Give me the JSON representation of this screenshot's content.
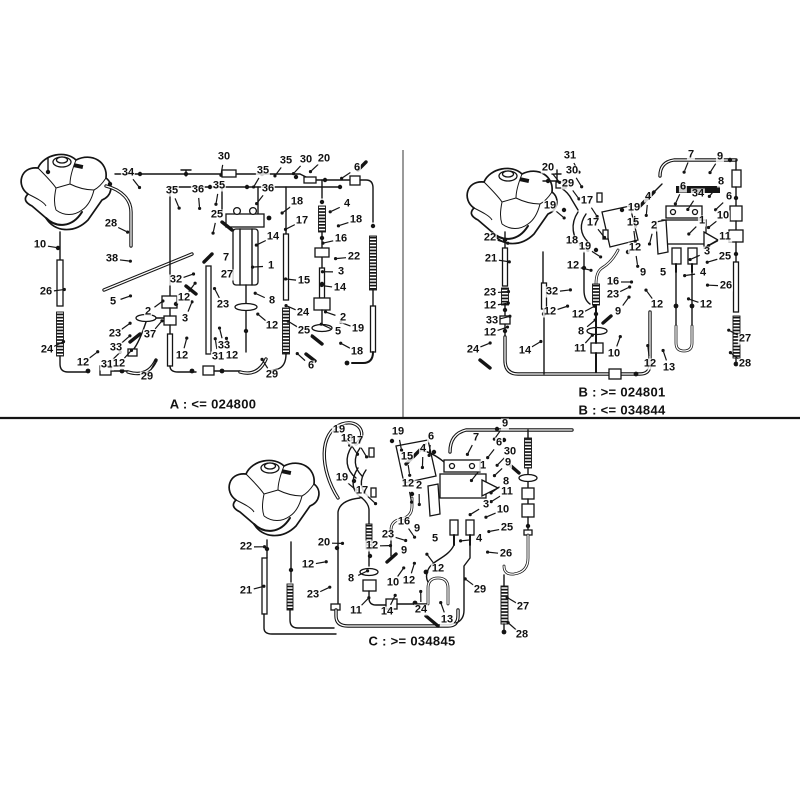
{
  "page": {
    "background": "#ffffff",
    "ink": "#141414",
    "divider_gray": "#9a9a9a"
  },
  "sections": [
    {
      "id": "A",
      "name": "variant-A-diagram",
      "captions": [
        {
          "text": "A : <= 024800",
          "x": 213,
          "y": 404
        }
      ],
      "focus": [
        205,
        270
      ],
      "callouts": [
        [
          "30",
          224,
          157
        ],
        [
          "35",
          263,
          171
        ],
        [
          "35",
          286,
          161
        ],
        [
          "30",
          306,
          160
        ],
        [
          "20",
          324,
          159
        ],
        [
          "6",
          357,
          168
        ],
        [
          "35",
          172,
          191
        ],
        [
          "36",
          198,
          190
        ],
        [
          "35",
          219,
          186
        ],
        [
          "36",
          268,
          189
        ],
        [
          "34",
          128,
          173
        ],
        [
          "28",
          111,
          224
        ],
        [
          "10",
          40,
          245
        ],
        [
          "26",
          46,
          292
        ],
        [
          "24",
          47,
          350
        ],
        [
          "38",
          112,
          259
        ],
        [
          "25",
          217,
          215
        ],
        [
          "18",
          297,
          202
        ],
        [
          "17",
          302,
          221
        ],
        [
          "16",
          341,
          239
        ],
        [
          "4",
          347,
          204
        ],
        [
          "18",
          356,
          220
        ],
        [
          "14",
          273,
          237
        ],
        [
          "7",
          226,
          258
        ],
        [
          "1",
          271,
          266
        ],
        [
          "22",
          354,
          257
        ],
        [
          "32",
          176,
          280
        ],
        [
          "27",
          227,
          275
        ],
        [
          "15",
          304,
          281
        ],
        [
          "3",
          341,
          272
        ],
        [
          "14",
          340,
          288
        ],
        [
          "5",
          113,
          302
        ],
        [
          "23",
          115,
          334
        ],
        [
          "33",
          116,
          348
        ],
        [
          "2",
          148,
          312
        ],
        [
          "12",
          184,
          298
        ],
        [
          "3",
          185,
          319
        ],
        [
          "37",
          150,
          335
        ],
        [
          "23",
          223,
          305
        ],
        [
          "33",
          224,
          346
        ],
        [
          "12",
          83,
          363
        ],
        [
          "31",
          107,
          365
        ],
        [
          "12",
          119,
          364
        ],
        [
          "29",
          147,
          377
        ],
        [
          "12",
          182,
          356
        ],
        [
          "31",
          218,
          357
        ],
        [
          "12",
          232,
          356
        ],
        [
          "29",
          272,
          375
        ],
        [
          "8",
          272,
          301
        ],
        [
          "24",
          303,
          313
        ],
        [
          "2",
          343,
          318
        ],
        [
          "12",
          272,
          326
        ],
        [
          "25",
          304,
          331
        ],
        [
          "5",
          338,
          332
        ],
        [
          "19",
          358,
          329
        ],
        [
          "18",
          357,
          352
        ],
        [
          "6",
          311,
          366
        ]
      ]
    },
    {
      "id": "B",
      "name": "variant-B-diagram",
      "captions": [
        {
          "text": "B : >= 024801",
          "x": 622,
          "y": 392
        },
        {
          "text": "B : <= 034844",
          "x": 622,
          "y": 410
        }
      ],
      "focus": [
        640,
        282
      ],
      "callouts": [
        [
          "31",
          570,
          156
        ],
        [
          "20",
          548,
          168
        ],
        [
          "30",
          572,
          171
        ],
        [
          "29",
          568,
          184
        ],
        [
          "19",
          550,
          206
        ],
        [
          "17",
          587,
          201
        ],
        [
          "19",
          634,
          208
        ],
        [
          "15",
          633,
          223
        ],
        [
          "17",
          593,
          223
        ],
        [
          "18",
          572,
          241
        ],
        [
          "19",
          585,
          247
        ],
        [
          "12",
          635,
          248
        ],
        [
          "22",
          490,
          238
        ],
        [
          "21",
          491,
          259
        ],
        [
          "12",
          573,
          266
        ],
        [
          "16",
          613,
          282
        ],
        [
          "7",
          691,
          155
        ],
        [
          "9",
          720,
          157
        ],
        [
          "6",
          683,
          187
        ],
        [
          "8",
          721,
          182
        ],
        [
          "4",
          648,
          197
        ],
        [
          "34",
          698,
          194
        ],
        [
          "6",
          729,
          197
        ],
        [
          "10",
          723,
          216
        ],
        [
          "1",
          702,
          221
        ],
        [
          "2",
          654,
          226
        ],
        [
          "11",
          725,
          237
        ],
        [
          "3",
          707,
          252
        ],
        [
          "25",
          725,
          257
        ],
        [
          "9",
          643,
          273
        ],
        [
          "5",
          663,
          273
        ],
        [
          "4",
          703,
          273
        ],
        [
          "26",
          726,
          286
        ],
        [
          "23",
          490,
          293
        ],
        [
          "12",
          490,
          306
        ],
        [
          "33",
          492,
          321
        ],
        [
          "12",
          490,
          333
        ],
        [
          "24",
          473,
          350
        ],
        [
          "14",
          525,
          351
        ],
        [
          "32",
          552,
          292
        ],
        [
          "12",
          550,
          312
        ],
        [
          "23",
          613,
          295
        ],
        [
          "12",
          578,
          315
        ],
        [
          "9",
          618,
          312
        ],
        [
          "8",
          581,
          332
        ],
        [
          "11",
          580,
          349
        ],
        [
          "10",
          614,
          354
        ],
        [
          "12",
          650,
          364
        ],
        [
          "12",
          657,
          305
        ],
        [
          "12",
          706,
          305
        ],
        [
          "13",
          669,
          368
        ],
        [
          "27",
          745,
          339
        ],
        [
          "28",
          745,
          364
        ]
      ]
    },
    {
      "id": "C",
      "name": "variant-C-diagram",
      "captions": [
        {
          "text": "C : >= 034845",
          "x": 412,
          "y": 641
        }
      ],
      "focus": [
        420,
        545
      ],
      "callouts": [
        [
          "19",
          339,
          430
        ],
        [
          "18",
          347,
          439
        ],
        [
          "17",
          357,
          441
        ],
        [
          "19",
          398,
          432
        ],
        [
          "15",
          407,
          457
        ],
        [
          "19",
          342,
          478
        ],
        [
          "17",
          362,
          491
        ],
        [
          "12",
          408,
          484
        ],
        [
          "2",
          419,
          486
        ],
        [
          "6",
          431,
          437
        ],
        [
          "7",
          476,
          438
        ],
        [
          "4",
          423,
          449
        ],
        [
          "1",
          483,
          466
        ],
        [
          "3",
          486,
          505
        ],
        [
          "9",
          417,
          529
        ],
        [
          "9",
          404,
          551
        ],
        [
          "5",
          435,
          539
        ],
        [
          "4",
          479,
          539
        ],
        [
          "16",
          404,
          522
        ],
        [
          "23",
          388,
          535
        ],
        [
          "12",
          372,
          546
        ],
        [
          "20",
          324,
          543
        ],
        [
          "22",
          246,
          547
        ],
        [
          "21",
          246,
          591
        ],
        [
          "12",
          308,
          565
        ],
        [
          "23",
          313,
          595
        ],
        [
          "9",
          505,
          424
        ],
        [
          "6",
          499,
          443
        ],
        [
          "30",
          510,
          452
        ],
        [
          "9",
          508,
          463
        ],
        [
          "8",
          506,
          482
        ],
        [
          "11",
          507,
          492
        ],
        [
          "10",
          503,
          510
        ],
        [
          "25",
          507,
          528
        ],
        [
          "26",
          506,
          554
        ],
        [
          "27",
          523,
          607
        ],
        [
          "28",
          522,
          635
        ],
        [
          "8",
          351,
          579
        ],
        [
          "12",
          438,
          569
        ],
        [
          "10",
          393,
          583
        ],
        [
          "12",
          409,
          581
        ],
        [
          "11",
          356,
          611
        ],
        [
          "14",
          387,
          612
        ],
        [
          "24",
          421,
          610
        ],
        [
          "13",
          447,
          620
        ],
        [
          "29",
          480,
          590
        ]
      ]
    }
  ]
}
